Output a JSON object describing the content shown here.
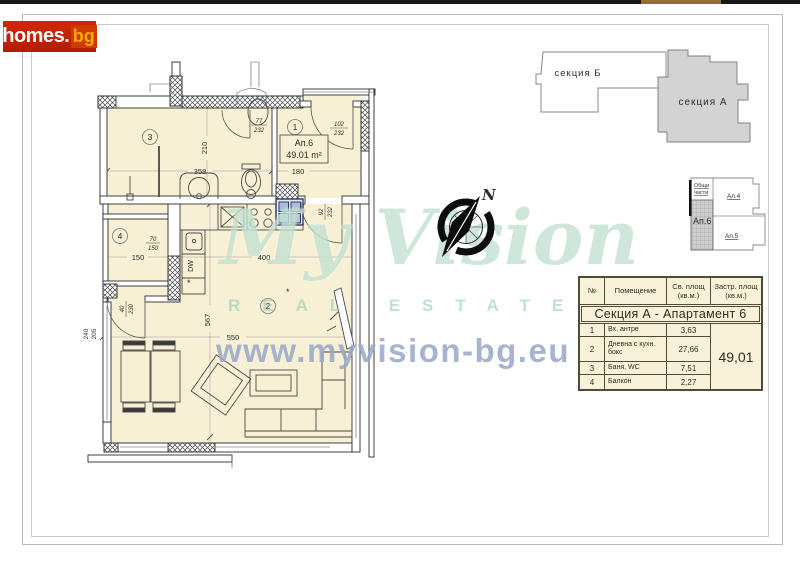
{
  "page": {
    "top_bar": {
      "color": "#171717",
      "accent_color": "#9a6a33"
    },
    "logo": {
      "name": "homes",
      "dot": ".",
      "tld": "bg",
      "bg_color": "#c32100",
      "name_color": "#ffffff",
      "tld_color": "#ffaa00"
    }
  },
  "sections_diagram": {
    "section_b_label": "секция Б",
    "section_a_label": "секция А",
    "section_a_fill": "#d3d3d3"
  },
  "key_plan": {
    "common_label_line1": "Общи",
    "common_label_line2": "части",
    "ap4": "Ап.4",
    "ap5": "Ап.5",
    "ap6": "Ап.6"
  },
  "compass": {
    "north": "N"
  },
  "watermark": {
    "brand": "My Vision",
    "tagline": "REAL ESTATE",
    "url": "www.myvision-bg.eu"
  },
  "floor_plan": {
    "unit": {
      "name": "Ап.6",
      "area": "49.01 m²"
    },
    "rooms": {
      "r1": "1",
      "r2": "2",
      "r3": "3",
      "r4": "4"
    },
    "dims": {
      "bath_w": "358",
      "bath_h": "210",
      "antre_w": "180",
      "balcony_w": "150",
      "kitchen_w": "400",
      "living_w": "550",
      "living_h": "567",
      "west_w": "240",
      "west_h": "205"
    },
    "openings": {
      "bath_door_w": "77",
      "bath_door_h": "232",
      "entry_door_w": "102",
      "entry_door_h": "232",
      "living_door_w": "92",
      "living_door_h": "232",
      "balcony_door_w": "40",
      "balcony_door_h": "230",
      "balcony_window_w": "70",
      "balcony_window_h": "150"
    },
    "labels": {
      "dishwasher": "DW",
      "marker": "*"
    },
    "colors": {
      "floor": "#f7f0d5",
      "wall": "#2e2e2e",
      "glass_block": "#aebdde"
    }
  },
  "area_table": {
    "headers": {
      "num": "№",
      "room": "Помещение",
      "net": "Св. площ (кв.м.)",
      "built": "Застр. площ (кв.м.)"
    },
    "title": "Секция А - Апартамент 6",
    "rows": [
      {
        "num": "1",
        "name": "Вх. антре",
        "area": "3,63"
      },
      {
        "num": "2",
        "name": "Дневна с кухн. бокс",
        "area": "27,66"
      },
      {
        "num": "3",
        "name": "Баня, WC",
        "area": "7,51"
      },
      {
        "num": "4",
        "name": "Балкон",
        "area": "2,27"
      }
    ],
    "total": "49,01"
  }
}
